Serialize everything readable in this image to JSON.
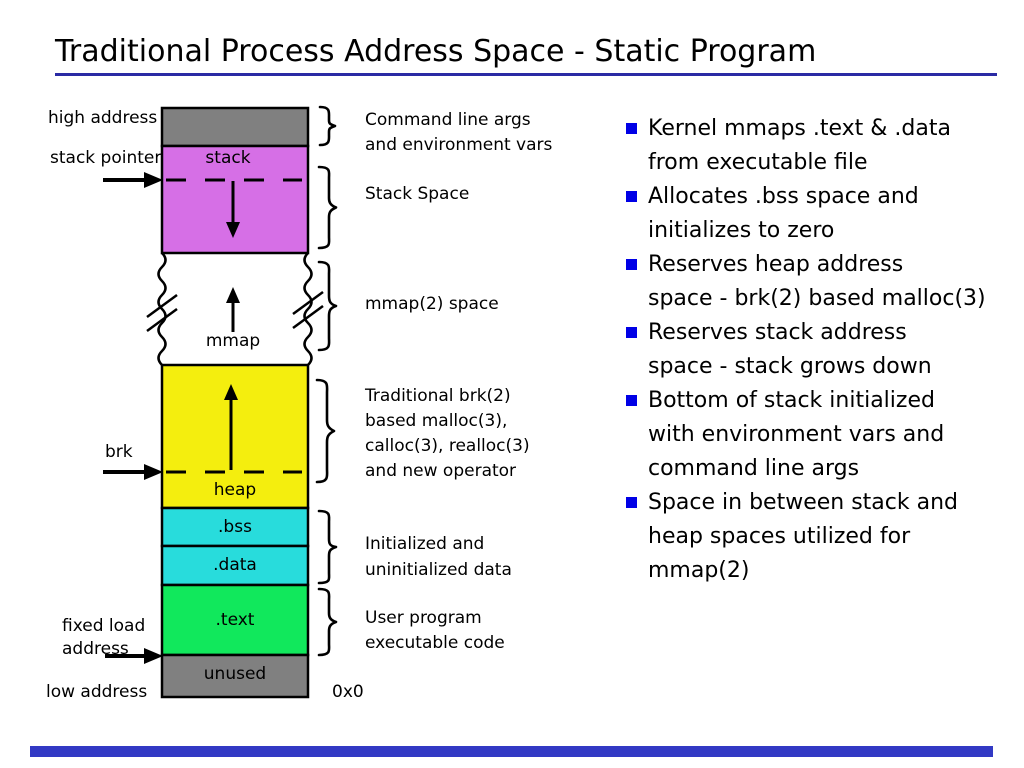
{
  "title": "Traditional Process Address Space - Static Program",
  "colors": {
    "underline": "#2A2AA4",
    "footer_bar": "#3239C4",
    "bullet": "#0000E6",
    "block_argv": "#808080",
    "block_stack": "#D66FE6",
    "block_mmap": "#FFFFFF",
    "block_heap": "#F4EE0E",
    "block_bss": "#28DCDC",
    "block_data": "#28DCDC",
    "block_text": "#11E85C",
    "block_unused": "#808080"
  },
  "diagram": {
    "left_labels": {
      "high_address": "high address",
      "stack_pointer": "stack pointer",
      "brk": "brk",
      "fixed_load_line1": "fixed load",
      "fixed_load_line2": "address",
      "low_address": "low address"
    },
    "blocks": {
      "stack": "stack",
      "mmap": "mmap",
      "heap": "heap",
      "bss": ".bss",
      "data": ".data",
      "text": ".text",
      "unused": "unused"
    },
    "annotations": {
      "argv_line1": "Command line args",
      "argv_line2": "and environment vars",
      "stack_space": "Stack Space",
      "mmap_space": "mmap(2) space",
      "heap_line1": "Traditional brk(2)",
      "heap_line2": "based malloc(3),",
      "heap_line3": "calloc(3), realloc(3)",
      "heap_line4": "and new operator",
      "data_line1": "Initialized and",
      "data_line2": "uninitialized data",
      "text_line1": "User program",
      "text_line2": "executable code",
      "zero_addr": "0x0"
    }
  },
  "bullets": [
    {
      "lines": [
        "Kernel mmaps .text & .data",
        "from executable file"
      ]
    },
    {
      "lines": [
        "Allocates .bss space and",
        "initializes to zero"
      ]
    },
    {
      "lines": [
        "Reserves heap address",
        "space - brk(2) based malloc(3)"
      ]
    },
    {
      "lines": [
        "Reserves stack address",
        "space - stack grows down"
      ]
    },
    {
      "lines": [
        "Bottom of stack initialized",
        "with environment vars and",
        "command line args"
      ]
    },
    {
      "lines": [
        "Space in between stack and",
        "heap spaces utilized for",
        "mmap(2)"
      ]
    }
  ]
}
